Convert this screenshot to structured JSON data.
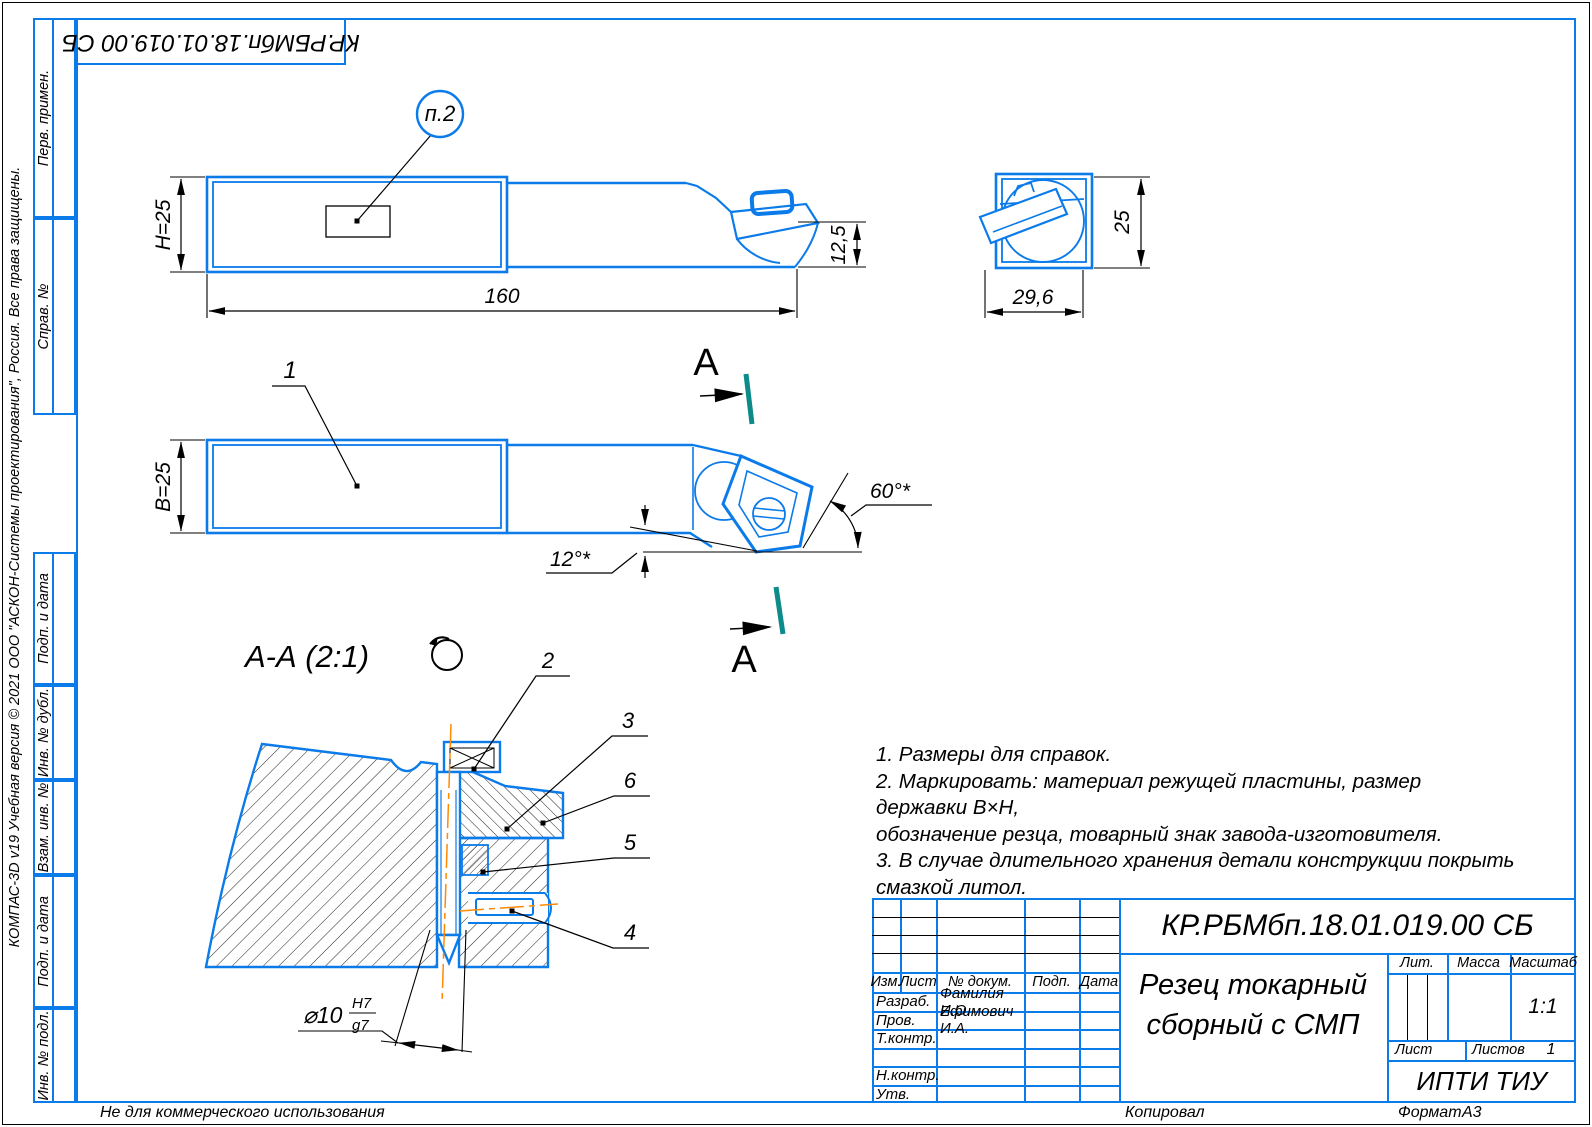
{
  "sheet": {
    "watermark_side": "КОМПАС-3D v19 Учебная версия © 2021 ООО \"АСКОН-Системы проектирования\", Россия. Все права защищены.",
    "watermark_bottom": "Не для коммерческого использования",
    "footer": {
      "copied_by": "Копировал",
      "format_label": "Формат",
      "format_value": "А3"
    },
    "colors": {
      "line_blue": "#0b7bea",
      "centerline_orange": "#ff8a00",
      "section_mark_teal": "#0d8a8a"
    }
  },
  "margin": {
    "top_designation": "КР.РБМбп.18.01.019.00 СБ",
    "labels": [
      "Перв. примен.",
      "Справ. №",
      "Подп. и дата",
      "Инв. № дубл.",
      "Взам. инв. №",
      "Подп. и дата",
      "Инв. № подл."
    ]
  },
  "notes": {
    "l1": "1. Размеры для справок.",
    "l2": "2. Маркировать: материал режущей пластины, размер державки В×Н,",
    "l3": "обозначение резца, товарный знак завода-изготовителя.",
    "l4": "3. В случае длительного хранения детали конструкции покрыть",
    "l5": "смазкой литол."
  },
  "views": {
    "top": {
      "balloon": "п.2",
      "dim_height": "H=25",
      "dim_length": "160",
      "dim_tip_drop": "12,5"
    },
    "end": {
      "dim_height": "25",
      "dim_width": "29,6"
    },
    "front": {
      "item": "1",
      "angle_main": "60°*",
      "angle_incline": "12°*",
      "cut_letter": "А"
    },
    "section": {
      "title": "А-А (2:1)",
      "item2": "2",
      "item3": "3",
      "item4": "4",
      "item5": "5",
      "item6": "6",
      "dia": "⌀10",
      "fit_upper": "H7",
      "fit_lower": "g7"
    }
  },
  "title_block": {
    "designation": "КР.РБМбп.18.01.019.00 СБ",
    "title1": "Резец токарный",
    "title2": "сборный с СМП",
    "org": "ИПТИ ТИУ",
    "head": {
      "izm": "Изм.",
      "list": "Лист",
      "doc": "№ докум.",
      "sign": "Подп.",
      "date": "Дата"
    },
    "props": {
      "lit": "Лит.",
      "mass": "Масса",
      "scale_label": "Масштаб",
      "scale": "1:1",
      "sheet": "Лист",
      "sheets_label": "Листов",
      "sheets_value": "1"
    },
    "rows": [
      {
        "label": "Разраб.",
        "value": "Фамилия И.О."
      },
      {
        "label": "Пров.",
        "value": "Ефимович И.А."
      },
      {
        "label": "Т.контр.",
        "value": ""
      },
      {
        "label": "",
        "value": ""
      },
      {
        "label": "Н.контр.",
        "value": ""
      },
      {
        "label": "Утв.",
        "value": ""
      }
    ]
  }
}
